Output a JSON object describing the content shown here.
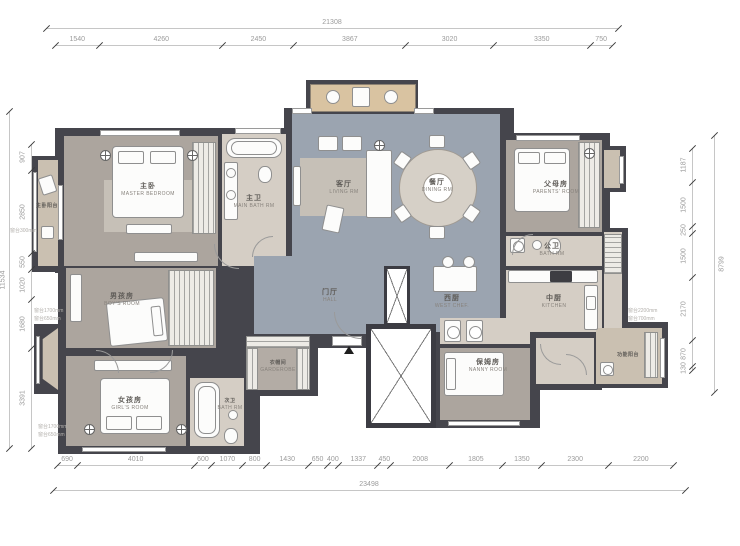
{
  "dims": {
    "top": {
      "total": "21308",
      "segments": [
        "1540",
        "4260",
        "2450",
        "3867",
        "3020",
        "3350",
        "750"
      ]
    },
    "bottom": {
      "total": "23498",
      "segments": [
        "690",
        "4010",
        "600",
        "1070",
        "800",
        "1430",
        "650",
        "400",
        "1337",
        "450",
        "2008",
        "1805",
        "1350",
        "2300",
        "2200"
      ]
    },
    "left": {
      "total": "11534",
      "segments": [
        "907",
        "2850",
        "550",
        "1020",
        "1680",
        "3391"
      ]
    },
    "right": {
      "total": "8799",
      "segments": [
        "1187",
        "1500",
        "250",
        "1500",
        "2170",
        "870",
        "130"
      ]
    }
  },
  "rooms": {
    "master_balcony": {
      "cn": "主卧阳台",
      "en": ""
    },
    "master": {
      "cn": "主卧",
      "en": "MASTER BEDROOM"
    },
    "main_bath": {
      "cn": "主卫",
      "en": "MAIN BATH RM"
    },
    "living": {
      "cn": "客厅",
      "en": "LIVING RM"
    },
    "dining": {
      "cn": "餐厅",
      "en": "DINING RM"
    },
    "parents": {
      "cn": "父母房",
      "en": "PARENTS' ROOM"
    },
    "public_bath": {
      "cn": "公卫",
      "en": "BATH RM"
    },
    "kitchen": {
      "cn": "中厨",
      "en": "KITCHEN"
    },
    "west_kitchen": {
      "cn": "西厨",
      "en": "WEST CHEF."
    },
    "hall": {
      "cn": "门厅",
      "en": "HALL"
    },
    "nanny": {
      "cn": "保姆房",
      "en": "NANNY ROOM"
    },
    "func_balcony": {
      "cn": "功能阳台",
      "en": ""
    },
    "boy": {
      "cn": "男孩房",
      "en": "BOY'S ROOM"
    },
    "girl": {
      "cn": "女孩房",
      "en": "GIRL'S ROOM"
    },
    "cloak": {
      "cn": "衣帽间",
      "en": "GARDEROBE"
    },
    "second_bath": {
      "cn": "次卫",
      "en": "BATH RM"
    }
  },
  "annotations": {
    "balcony_sill": {
      "line1": "窗台300mm",
      "line2": ""
    },
    "bay_upper": {
      "line1": "窗台1700mm",
      "line2": "窗台650mm"
    },
    "bay_lower": {
      "line1": "窗台1700mm",
      "line2": "窗台650mm"
    },
    "func_sill": {
      "line1": "窗台2200mm",
      "line2": "窗台700mm"
    }
  },
  "colors": {
    "wall": "#45454c",
    "floor_living": "#9ba4b0",
    "floor_bedroom": "#aca59e",
    "floor_bath": "#d5cec5",
    "floor_balcony": "#cac0b1",
    "wood": "#d9c3a1"
  }
}
